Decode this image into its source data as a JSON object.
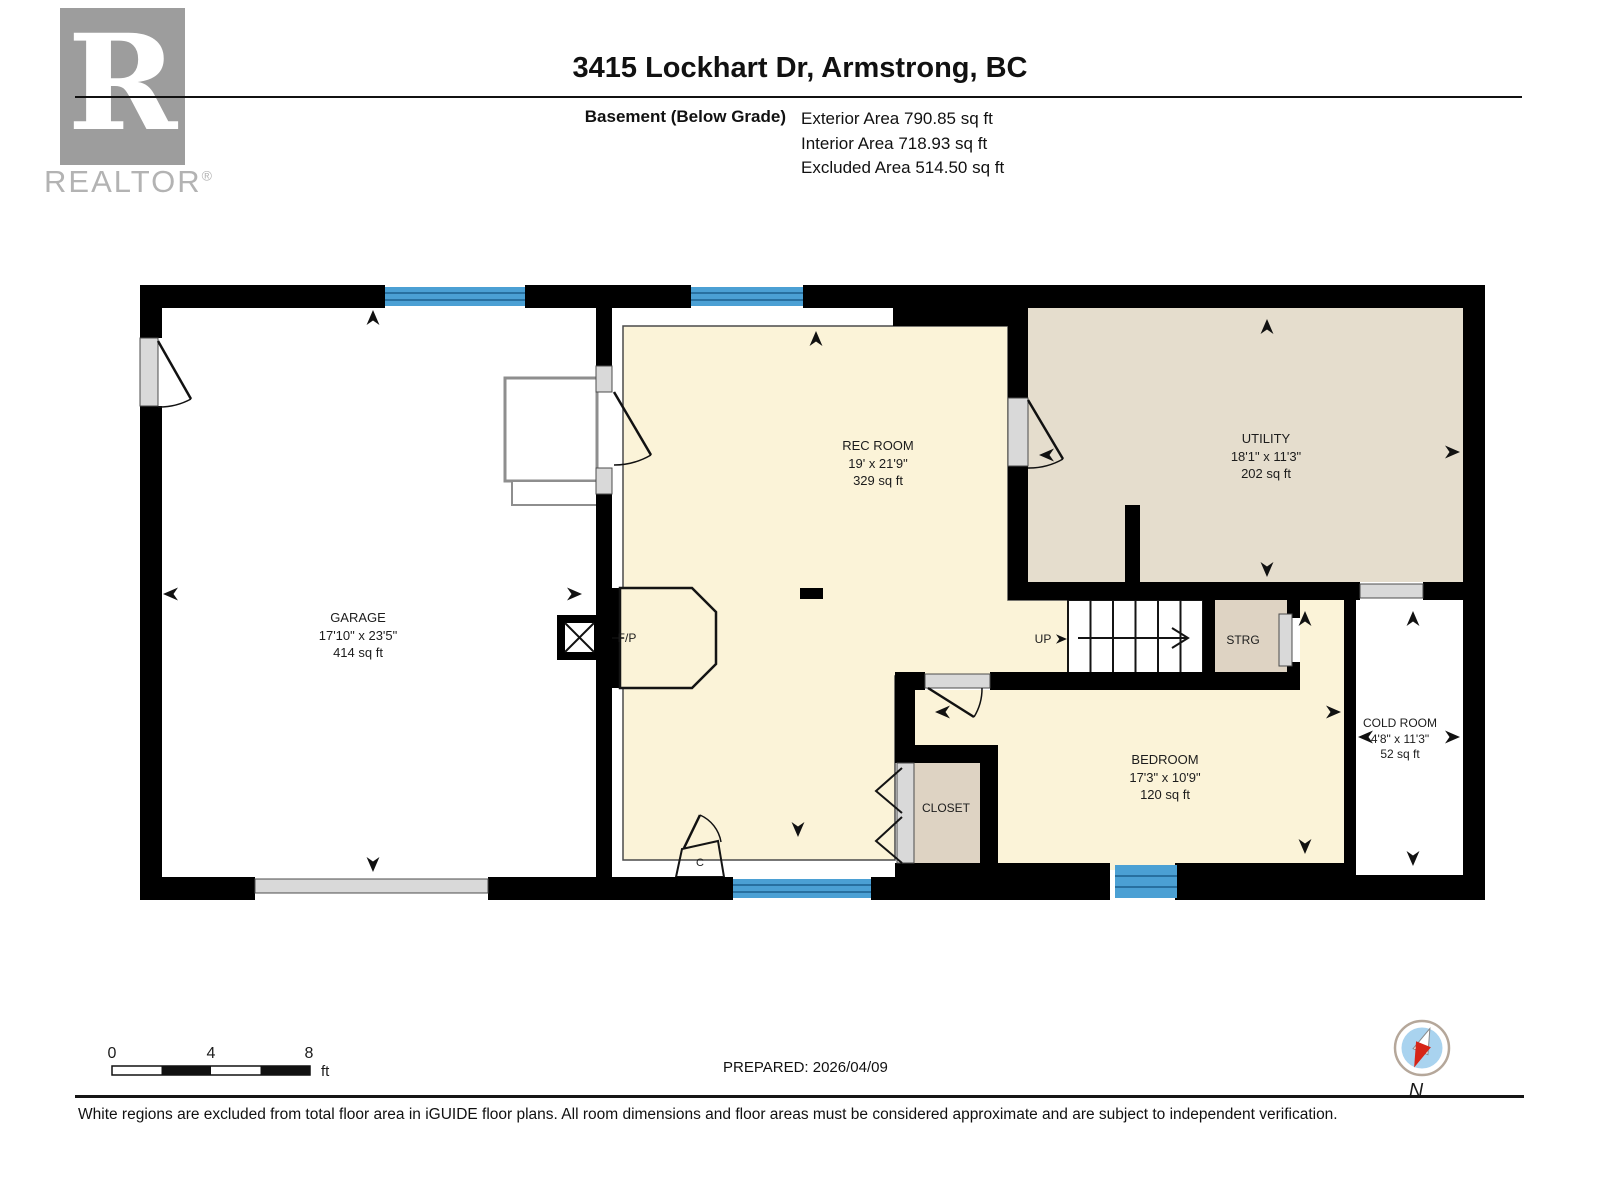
{
  "brand": {
    "logo_letter": "R",
    "name": "REALTOR",
    "reg": "®"
  },
  "header": {
    "title": "3415 Lockhart Dr, Armstrong, BC",
    "floor_label": "Basement (Below Grade)",
    "area_lines": [
      "Exterior Area 790.85 sq ft",
      "Interior Area 718.93 sq ft",
      "Excluded Area 514.50 sq ft"
    ]
  },
  "rooms": {
    "garage": {
      "name": "GARAGE",
      "dims": "17'10\" x 23'5\"",
      "area": "414 sq ft"
    },
    "rec_room": {
      "name": "REC ROOM",
      "dims": "19' x 21'9\"",
      "area": "329 sq ft"
    },
    "utility": {
      "name": "UTILITY",
      "dims": "18'1\" x 11'3\"",
      "area": "202 sq ft"
    },
    "bedroom": {
      "name": "BEDROOM",
      "dims": "17'3\" x 10'9\"",
      "area": "120 sq ft"
    },
    "cold_room": {
      "name": "COLD ROOM",
      "dims": "4'8\" x 11'3\"",
      "area": "52 sq ft"
    },
    "storage": {
      "name": "STRG"
    },
    "closet": {
      "name": "CLOSET"
    },
    "small_closet": {
      "name": "C"
    },
    "stairs": {
      "label": "UP"
    },
    "fireplace": {
      "label": "F/P"
    }
  },
  "footer": {
    "scale": {
      "ticks": [
        "0",
        "4",
        "8"
      ],
      "unit": "ft"
    },
    "prepared": "PREPARED: 2026/04/09",
    "compass": "N",
    "disclaimer": "White regions are excluded from total floor area in iGUIDE floor plans. All room dimensions and floor areas must be considered approximate and are subject to independent verification."
  },
  "colors": {
    "wall": "#000000",
    "floor_cream": "#fbf3d8",
    "floor_tan": "#e5ddcd",
    "floor_tan2": "#ded3c3",
    "window": "#4ba0d4",
    "window_line": "#1d608f",
    "stair_gray": "#dcdcdc",
    "sill_gray": "#d9d9d9",
    "logo_gray": "#9d9d9d",
    "brand_gray": "#b3b3b3",
    "compass_blue": "#a9d3ef",
    "compass_red": "#d62517"
  }
}
